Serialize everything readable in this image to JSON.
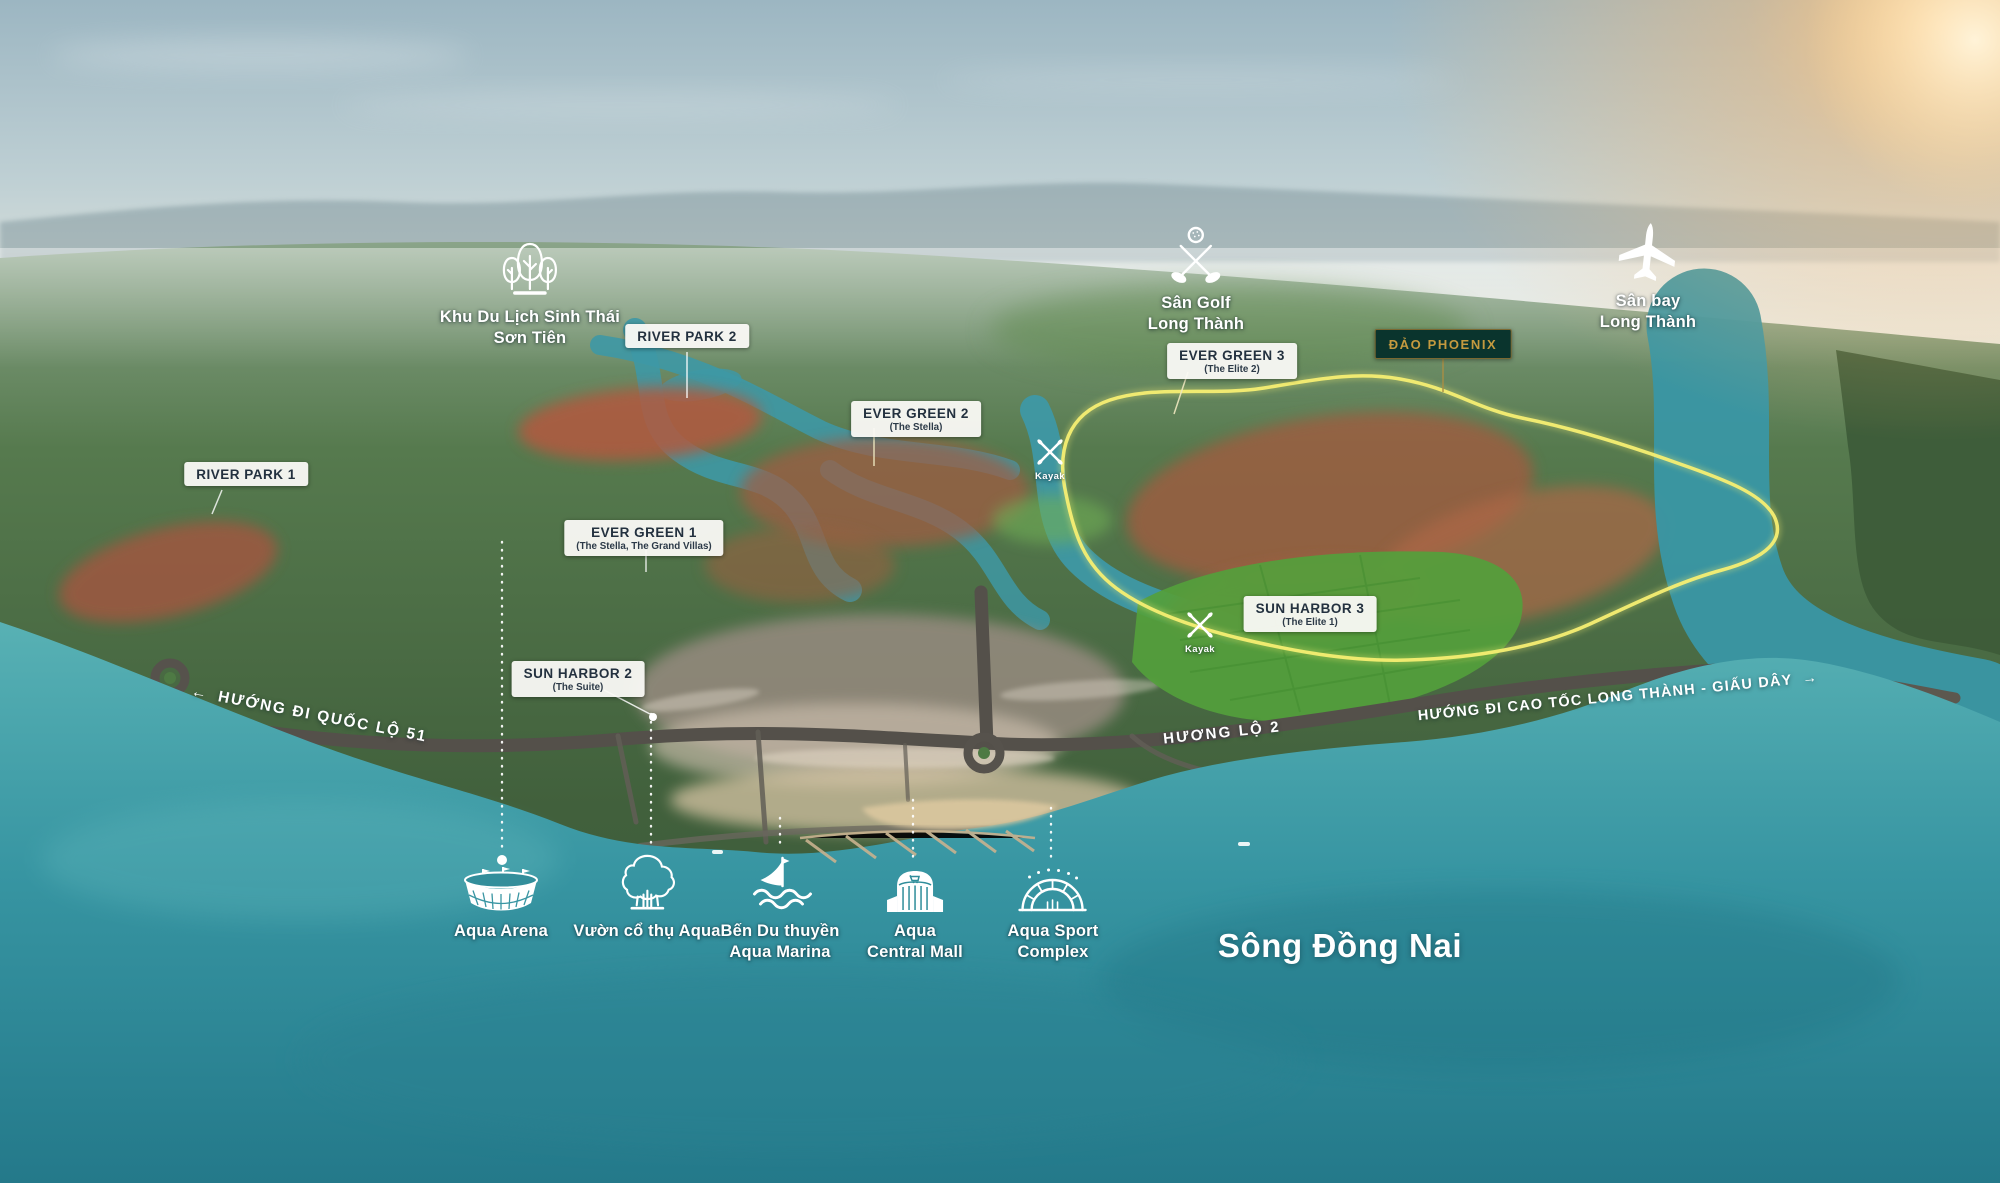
{
  "landmarks": {
    "son_tien": {
      "line1": "Khu Du Lịch Sinh Thái",
      "line2": "Sơn Tiên",
      "icon": "trees-icon"
    },
    "golf": {
      "line1": "Sân Golf",
      "line2": "Long Thành",
      "icon": "golf-icon"
    },
    "airport": {
      "line1": "Sân bay",
      "line2": "Long Thành",
      "icon": "airplane-icon"
    },
    "phoenix_island": {
      "label": "ĐẢO PHOENIX"
    },
    "river": {
      "label": "Sông Đồng Nai"
    },
    "kayak": {
      "label": "Kayak",
      "icon": "kayak-icon"
    }
  },
  "chips": [
    {
      "title": "RIVER PARK 1",
      "subtitle": ""
    },
    {
      "title": "RIVER PARK 2",
      "subtitle": ""
    },
    {
      "title": "EVER GREEN 1",
      "subtitle": "(The Stella, The Grand Villas)"
    },
    {
      "title": "EVER GREEN 2",
      "subtitle": "(The Stella)"
    },
    {
      "title": "EVER GREEN 3",
      "subtitle": "(The Elite 2)"
    },
    {
      "title": "SUN HARBOR 2",
      "subtitle": "(The Suite)"
    },
    {
      "title": "SUN HARBOR 3",
      "subtitle": "(The Elite 1)"
    }
  ],
  "directions": [
    {
      "text": "HƯỚNG ĐI QUỐC LỘ 51",
      "arrow_glyph": "←",
      "arrow_side": "left"
    },
    {
      "text": "HƯỚNG ĐI CAO TỐC LONG THÀNH - GIẤU DÂY",
      "arrow_glyph": "→",
      "arrow_side": "right"
    },
    {
      "text": "HƯƠNG LỘ 2",
      "arrow_glyph": "",
      "arrow_side": "none"
    }
  ],
  "amenities": [
    {
      "label": "Aqua Arena",
      "icon": "arena-icon"
    },
    {
      "label": "Vườn cổ thụ Aqua",
      "icon": "old-tree-icon"
    },
    {
      "line1": "Bến Du thuyền",
      "line2": "Aqua Marina",
      "icon": "sailboat-icon"
    },
    {
      "line1": "Aqua",
      "line2": "Central Mall",
      "icon": "mall-icon"
    },
    {
      "line1": "Aqua Sport",
      "line2": "Complex",
      "icon": "sport-stadium-icon"
    }
  ],
  "colors": {
    "chip_bg": "#faf9f5",
    "chip_text": "#23313f",
    "phoenix_bg": "#0a342d",
    "phoenix_text": "#c49a3f",
    "phoenix_border": "#7a6831",
    "outline_yellow": "#f6ee72",
    "label_white": "#ffffff",
    "water_teal": "#3a96a3"
  }
}
